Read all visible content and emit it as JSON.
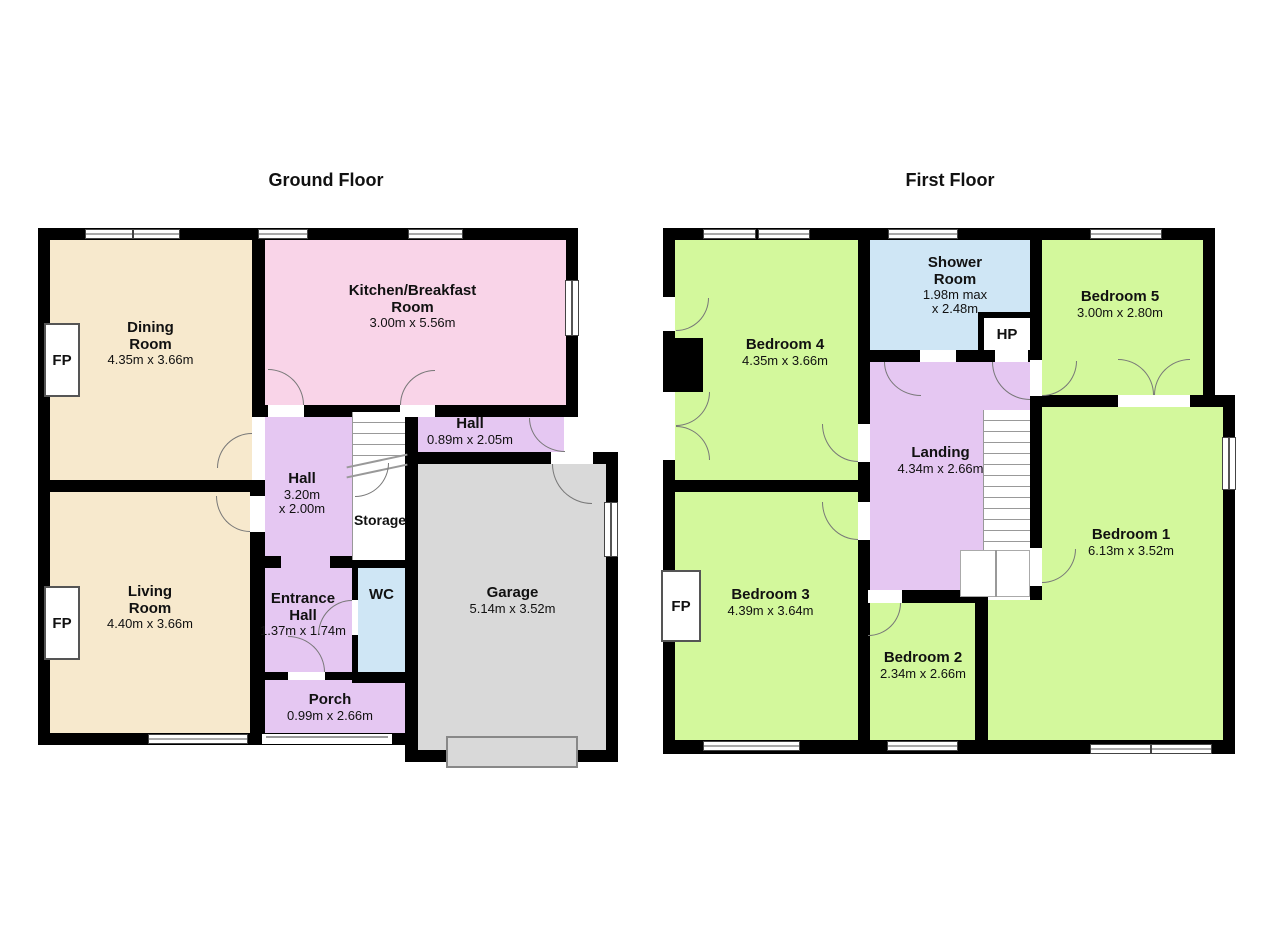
{
  "ground_floor": {
    "title": "Ground Floor",
    "rooms": {
      "dining": {
        "name": [
          "Dining",
          "Room"
        ],
        "dims": [
          "4.35m x 3.66m"
        ]
      },
      "kitchen": {
        "name": [
          "Kitchen/Breakfast",
          "Room"
        ],
        "dims": [
          "3.00m x 5.56m"
        ]
      },
      "hall_upper": {
        "name": [
          "Hall"
        ],
        "dims": [
          "0.89m x 2.05m"
        ]
      },
      "hall": {
        "name": [
          "Hall"
        ],
        "dims": [
          "3.20m",
          "x 2.00m"
        ]
      },
      "storage": {
        "name": [
          "Storage"
        ],
        "dims": []
      },
      "entrance_hall": {
        "name": [
          "Entrance",
          "Hall"
        ],
        "dims": [
          "1.37m x 1.74m"
        ]
      },
      "wc": {
        "name": [
          "WC"
        ],
        "dims": []
      },
      "living": {
        "name": [
          "Living",
          "Room"
        ],
        "dims": [
          "4.40m x 3.66m"
        ]
      },
      "porch": {
        "name": [
          "Porch"
        ],
        "dims": [
          "0.99m x 2.66m"
        ]
      },
      "garage": {
        "name": [
          "Garage"
        ],
        "dims": [
          "5.14m x 3.52m"
        ]
      }
    },
    "fireplace_label": "FP"
  },
  "first_floor": {
    "title": "First Floor",
    "rooms": {
      "bedroom4": {
        "name": [
          "Bedroom 4"
        ],
        "dims": [
          "4.35m x 3.66m"
        ]
      },
      "shower": {
        "name": [
          "Shower",
          "Room"
        ],
        "dims": [
          "1.98m max",
          "x 2.48m"
        ]
      },
      "hp": {
        "name": [
          "HP"
        ],
        "dims": []
      },
      "bedroom5": {
        "name": [
          "Bedroom 5"
        ],
        "dims": [
          "3.00m x 2.80m"
        ]
      },
      "landing": {
        "name": [
          "Landing"
        ],
        "dims": [
          "4.34m x 2.66m"
        ]
      },
      "bedroom3": {
        "name": [
          "Bedroom 3"
        ],
        "dims": [
          "4.39m x 3.64m"
        ]
      },
      "bedroom2": {
        "name": [
          "Bedroom 2"
        ],
        "dims": [
          "2.34m x 2.66m"
        ]
      },
      "bedroom1": {
        "name": [
          "Bedroom 1"
        ],
        "dims": [
          "6.13m x 3.52m"
        ]
      }
    },
    "fireplace_label": "FP"
  },
  "colors": {
    "wall": "#000000",
    "cream": "#f7e9cd",
    "pink": "#f9d4e8",
    "lavender": "#e5c7f2",
    "blue": "#cfe6f5",
    "green": "#d3f89c",
    "garage_gray": "#d9d9d9",
    "background": "#ffffff"
  }
}
